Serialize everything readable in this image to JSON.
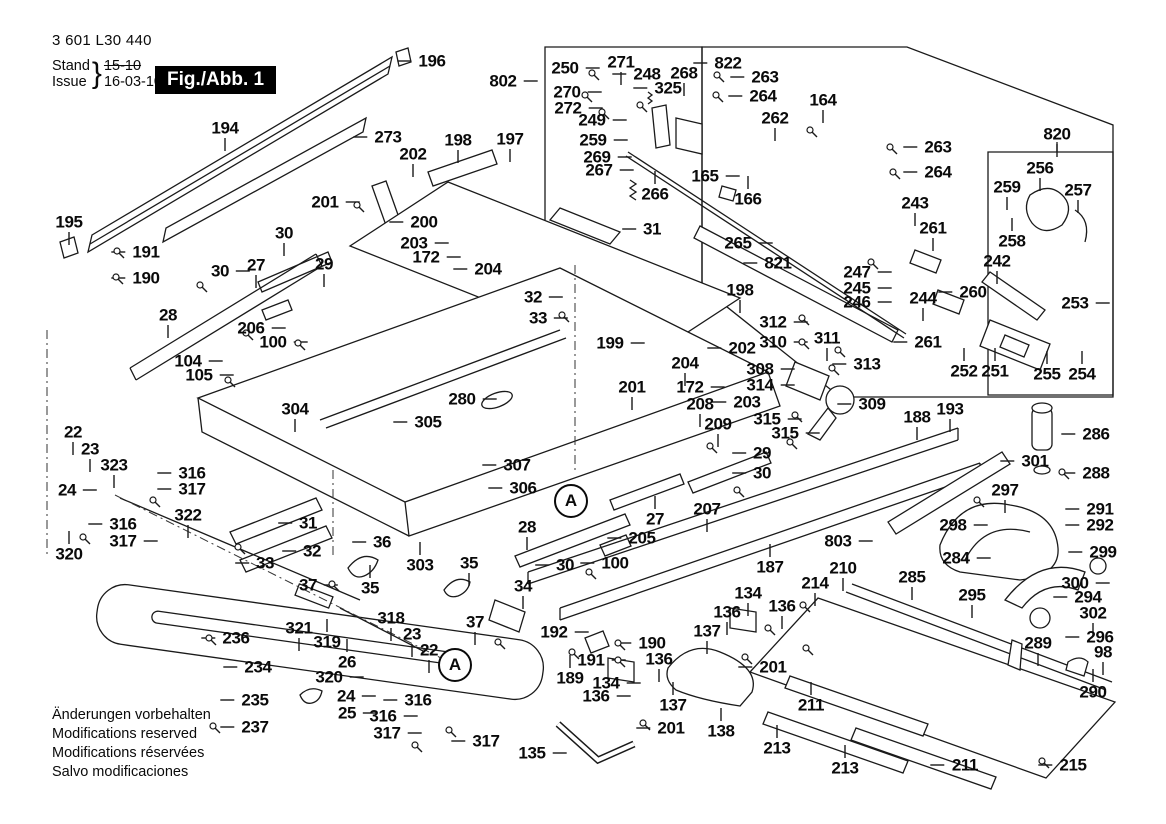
{
  "header": {
    "part_number": "3 601 L30 440",
    "stand_label": "Stand",
    "issue_label": "Issue",
    "brace": "}",
    "old_date": "15-10",
    "new_date": "16-03-10"
  },
  "figure_box": {
    "label": "Fig./Abb. 1"
  },
  "footer_lines": [
    "Änderungen vorbehalten",
    "Modifications reserved",
    "Modifications réservées",
    "Salvo modificaciones"
  ],
  "colors": {
    "ink": "#1a1a1a",
    "paper": "#ffffff"
  },
  "detail_markers": [
    {
      "label": "A",
      "x": 571,
      "y": 501
    },
    {
      "label": "A",
      "x": 455,
      "y": 665
    }
  ],
  "part_labels": [
    {
      "t": "194",
      "x": 225,
      "y": 128,
      "d": "b"
    },
    {
      "t": "195",
      "x": 69,
      "y": 222,
      "d": "b"
    },
    {
      "t": "196",
      "x": 432,
      "y": 61,
      "d": "l"
    },
    {
      "t": "273",
      "x": 388,
      "y": 137,
      "d": "l"
    },
    {
      "t": "198",
      "x": 458,
      "y": 140,
      "d": "b"
    },
    {
      "t": "197",
      "x": 510,
      "y": 139,
      "d": "b"
    },
    {
      "t": "202",
      "x": 413,
      "y": 154,
      "d": "b"
    },
    {
      "t": "201",
      "x": 325,
      "y": 202,
      "d": "r"
    },
    {
      "t": "200",
      "x": 424,
      "y": 222,
      "d": "l"
    },
    {
      "t": "30",
      "x": 284,
      "y": 233,
      "d": "b"
    },
    {
      "t": "203",
      "x": 414,
      "y": 243,
      "d": "r"
    },
    {
      "t": "172",
      "x": 426,
      "y": 257,
      "d": "r"
    },
    {
      "t": "204",
      "x": 488,
      "y": 269,
      "d": "l"
    },
    {
      "t": "27",
      "x": 256,
      "y": 265,
      "d": "b"
    },
    {
      "t": "29",
      "x": 324,
      "y": 264,
      "d": "b"
    },
    {
      "t": "30",
      "x": 220,
      "y": 271,
      "d": "r"
    },
    {
      "t": "191",
      "x": 146,
      "y": 252,
      "d": "l"
    },
    {
      "t": "190",
      "x": 146,
      "y": 278,
      "d": "l"
    },
    {
      "t": "28",
      "x": 168,
      "y": 315,
      "d": "b"
    },
    {
      "t": "206",
      "x": 251,
      "y": 328,
      "d": "r"
    },
    {
      "t": "100",
      "x": 273,
      "y": 342,
      "d": "r"
    },
    {
      "t": "104",
      "x": 188,
      "y": 361,
      "d": "r"
    },
    {
      "t": "105",
      "x": 199,
      "y": 375,
      "d": "r"
    },
    {
      "t": "802",
      "x": 503,
      "y": 81,
      "d": "r"
    },
    {
      "t": "250",
      "x": 565,
      "y": 68,
      "d": "r"
    },
    {
      "t": "271",
      "x": 621,
      "y": 62,
      "d": "b"
    },
    {
      "t": "248",
      "x": 647,
      "y": 74,
      "d": "l"
    },
    {
      "t": "268",
      "x": 684,
      "y": 73,
      "d": "b"
    },
    {
      "t": "325",
      "x": 668,
      "y": 88,
      "d": "l"
    },
    {
      "t": "270",
      "x": 567,
      "y": 92,
      "d": "r"
    },
    {
      "t": "272",
      "x": 568,
      "y": 108,
      "d": "r"
    },
    {
      "t": "249",
      "x": 592,
      "y": 120,
      "d": "r"
    },
    {
      "t": "259",
      "x": 593,
      "y": 140,
      "d": "r"
    },
    {
      "t": "269",
      "x": 597,
      "y": 157,
      "d": "r"
    },
    {
      "t": "267",
      "x": 599,
      "y": 170,
      "d": "r"
    },
    {
      "t": "266",
      "x": 655,
      "y": 194,
      "d": "t"
    },
    {
      "t": "265",
      "x": 738,
      "y": 243,
      "d": "r"
    },
    {
      "t": "821",
      "x": 778,
      "y": 263,
      "d": "l"
    },
    {
      "t": "31",
      "x": 652,
      "y": 229,
      "d": "l"
    },
    {
      "t": "165",
      "x": 705,
      "y": 176,
      "d": "r"
    },
    {
      "t": "166",
      "x": 748,
      "y": 199,
      "d": "t"
    },
    {
      "t": "822",
      "x": 728,
      "y": 63,
      "d": "l"
    },
    {
      "t": "263",
      "x": 765,
      "y": 77,
      "d": "l"
    },
    {
      "t": "264",
      "x": 763,
      "y": 96,
      "d": "l"
    },
    {
      "t": "164",
      "x": 823,
      "y": 100,
      "d": "b"
    },
    {
      "t": "262",
      "x": 775,
      "y": 118,
      "d": "b"
    },
    {
      "t": "263",
      "x": 938,
      "y": 147,
      "d": "l"
    },
    {
      "t": "264",
      "x": 938,
      "y": 172,
      "d": "l"
    },
    {
      "t": "243",
      "x": 915,
      "y": 203,
      "d": "b"
    },
    {
      "t": "261",
      "x": 933,
      "y": 228,
      "d": "b"
    },
    {
      "t": "820",
      "x": 1057,
      "y": 134,
      "d": "b"
    },
    {
      "t": "256",
      "x": 1040,
      "y": 168,
      "d": "b"
    },
    {
      "t": "259",
      "x": 1007,
      "y": 187,
      "d": "b"
    },
    {
      "t": "257",
      "x": 1078,
      "y": 190,
      "d": "b"
    },
    {
      "t": "258",
      "x": 1012,
      "y": 241,
      "d": "t"
    },
    {
      "t": "242",
      "x": 997,
      "y": 261,
      "d": "b"
    },
    {
      "t": "260",
      "x": 973,
      "y": 292,
      "d": "l"
    },
    {
      "t": "253",
      "x": 1075,
      "y": 303,
      "d": "r"
    },
    {
      "t": "252",
      "x": 964,
      "y": 371,
      "d": "t"
    },
    {
      "t": "251",
      "x": 995,
      "y": 371,
      "d": "t"
    },
    {
      "t": "255",
      "x": 1047,
      "y": 374,
      "d": "t"
    },
    {
      "t": "254",
      "x": 1082,
      "y": 374,
      "d": "t"
    },
    {
      "t": "247",
      "x": 857,
      "y": 272,
      "d": "r"
    },
    {
      "t": "245",
      "x": 857,
      "y": 288,
      "d": "r"
    },
    {
      "t": "246",
      "x": 857,
      "y": 302,
      "d": "r"
    },
    {
      "t": "244",
      "x": 923,
      "y": 298,
      "d": "b"
    },
    {
      "t": "261",
      "x": 928,
      "y": 342,
      "d": "l"
    },
    {
      "t": "32",
      "x": 533,
      "y": 297,
      "d": "r"
    },
    {
      "t": "33",
      "x": 538,
      "y": 318,
      "d": "r"
    },
    {
      "t": "199",
      "x": 610,
      "y": 343,
      "d": "r"
    },
    {
      "t": "201",
      "x": 632,
      "y": 387,
      "d": "b"
    },
    {
      "t": "198",
      "x": 740,
      "y": 290,
      "d": "b"
    },
    {
      "t": "202",
      "x": 742,
      "y": 348,
      "d": "l"
    },
    {
      "t": "204",
      "x": 685,
      "y": 363,
      "d": "b"
    },
    {
      "t": "172",
      "x": 690,
      "y": 387,
      "d": "r"
    },
    {
      "t": "203",
      "x": 747,
      "y": 402,
      "d": "l"
    },
    {
      "t": "208",
      "x": 700,
      "y": 404,
      "d": "b"
    },
    {
      "t": "209",
      "x": 718,
      "y": 424,
      "d": "b"
    },
    {
      "t": "312",
      "x": 773,
      "y": 322,
      "d": "r"
    },
    {
      "t": "310",
      "x": 773,
      "y": 342,
      "d": "r"
    },
    {
      "t": "311",
      "x": 827,
      "y": 338,
      "d": "b"
    },
    {
      "t": "313",
      "x": 867,
      "y": 364,
      "d": "l"
    },
    {
      "t": "308",
      "x": 760,
      "y": 369,
      "d": "r"
    },
    {
      "t": "314",
      "x": 760,
      "y": 385,
      "d": "r"
    },
    {
      "t": "315",
      "x": 767,
      "y": 419,
      "d": "r"
    },
    {
      "t": "315",
      "x": 785,
      "y": 433,
      "d": "r"
    },
    {
      "t": "309",
      "x": 872,
      "y": 404,
      "d": "l"
    },
    {
      "t": "188",
      "x": 917,
      "y": 417,
      "d": "b"
    },
    {
      "t": "193",
      "x": 950,
      "y": 409,
      "d": "b"
    },
    {
      "t": "280",
      "x": 462,
      "y": 399,
      "d": "r"
    },
    {
      "t": "305",
      "x": 428,
      "y": 422,
      "d": "l"
    },
    {
      "t": "307",
      "x": 517,
      "y": 465,
      "d": "l"
    },
    {
      "t": "306",
      "x": 523,
      "y": 488,
      "d": "l"
    },
    {
      "t": "304",
      "x": 295,
      "y": 409,
      "d": "b"
    },
    {
      "t": "29",
      "x": 762,
      "y": 453,
      "d": "l"
    },
    {
      "t": "30",
      "x": 762,
      "y": 473,
      "d": "l"
    },
    {
      "t": "27",
      "x": 655,
      "y": 519,
      "d": "t"
    },
    {
      "t": "205",
      "x": 642,
      "y": 538,
      "d": "l"
    },
    {
      "t": "100",
      "x": 615,
      "y": 563,
      "d": "l"
    },
    {
      "t": "30",
      "x": 565,
      "y": 565,
      "d": "l"
    },
    {
      "t": "28",
      "x": 527,
      "y": 527,
      "d": "b"
    },
    {
      "t": "207",
      "x": 707,
      "y": 509,
      "d": "b"
    },
    {
      "t": "187",
      "x": 770,
      "y": 567,
      "d": "t"
    },
    {
      "t": "803",
      "x": 838,
      "y": 541,
      "d": "r"
    },
    {
      "t": "210",
      "x": 843,
      "y": 568,
      "d": "b"
    },
    {
      "t": "214",
      "x": 815,
      "y": 583,
      "d": "b"
    },
    {
      "t": "22",
      "x": 73,
      "y": 432,
      "d": "b"
    },
    {
      "t": "23",
      "x": 90,
      "y": 449,
      "d": "b"
    },
    {
      "t": "323",
      "x": 114,
      "y": 465,
      "d": "b"
    },
    {
      "t": "24",
      "x": 67,
      "y": 490,
      "d": "r"
    },
    {
      "t": "316",
      "x": 192,
      "y": 473,
      "d": "l"
    },
    {
      "t": "317",
      "x": 192,
      "y": 489,
      "d": "l"
    },
    {
      "t": "316",
      "x": 123,
      "y": 524,
      "d": "l"
    },
    {
      "t": "317",
      "x": 123,
      "y": 541,
      "d": "r"
    },
    {
      "t": "320",
      "x": 69,
      "y": 554,
      "d": "t"
    },
    {
      "t": "322",
      "x": 188,
      "y": 515,
      "d": "b"
    },
    {
      "t": "31",
      "x": 308,
      "y": 523,
      "d": "l"
    },
    {
      "t": "32",
      "x": 312,
      "y": 551,
      "d": "l"
    },
    {
      "t": "33",
      "x": 265,
      "y": 563,
      "d": "l"
    },
    {
      "t": "36",
      "x": 382,
      "y": 542,
      "d": "l"
    },
    {
      "t": "35",
      "x": 370,
      "y": 588,
      "d": "t"
    },
    {
      "t": "37",
      "x": 308,
      "y": 585,
      "d": "r"
    },
    {
      "t": "303",
      "x": 420,
      "y": 565,
      "d": "t"
    },
    {
      "t": "35",
      "x": 469,
      "y": 563,
      "d": "b"
    },
    {
      "t": "34",
      "x": 523,
      "y": 586,
      "d": "b"
    },
    {
      "t": "37",
      "x": 475,
      "y": 622,
      "d": "b"
    },
    {
      "t": "236",
      "x": 236,
      "y": 638,
      "d": "l"
    },
    {
      "t": "234",
      "x": 258,
      "y": 667,
      "d": "l"
    },
    {
      "t": "235",
      "x": 255,
      "y": 700,
      "d": "l"
    },
    {
      "t": "237",
      "x": 255,
      "y": 727,
      "d": "l"
    },
    {
      "t": "321",
      "x": 299,
      "y": 628,
      "d": "b"
    },
    {
      "t": "319",
      "x": 327,
      "y": 642,
      "d": "t"
    },
    {
      "t": "26",
      "x": 347,
      "y": 662,
      "d": "t"
    },
    {
      "t": "320",
      "x": 329,
      "y": 677,
      "d": "r"
    },
    {
      "t": "24",
      "x": 346,
      "y": 696,
      "d": "r"
    },
    {
      "t": "25",
      "x": 347,
      "y": 713,
      "d": "r"
    },
    {
      "t": "318",
      "x": 391,
      "y": 618,
      "d": "b"
    },
    {
      "t": "23",
      "x": 412,
      "y": 634,
      "d": "b"
    },
    {
      "t": "22",
      "x": 429,
      "y": 650,
      "d": "b"
    },
    {
      "t": "316",
      "x": 418,
      "y": 700,
      "d": "l"
    },
    {
      "t": "316",
      "x": 383,
      "y": 716,
      "d": "r"
    },
    {
      "t": "317",
      "x": 387,
      "y": 733,
      "d": "r"
    },
    {
      "t": "317",
      "x": 486,
      "y": 741,
      "d": "l"
    },
    {
      "t": "192",
      "x": 554,
      "y": 632,
      "d": "r"
    },
    {
      "t": "190",
      "x": 652,
      "y": 643,
      "d": "l"
    },
    {
      "t": "191",
      "x": 591,
      "y": 660,
      "d": "r"
    },
    {
      "t": "189",
      "x": 570,
      "y": 678,
      "d": "t"
    },
    {
      "t": "134",
      "x": 748,
      "y": 593,
      "d": "b"
    },
    {
      "t": "136",
      "x": 727,
      "y": 612,
      "d": "b"
    },
    {
      "t": "136",
      "x": 782,
      "y": 606,
      "d": "b"
    },
    {
      "t": "137",
      "x": 707,
      "y": 631,
      "d": "b"
    },
    {
      "t": "201",
      "x": 773,
      "y": 667,
      "d": "l"
    },
    {
      "t": "136",
      "x": 659,
      "y": 659,
      "d": "b"
    },
    {
      "t": "134",
      "x": 606,
      "y": 683,
      "d": "r"
    },
    {
      "t": "136",
      "x": 596,
      "y": 696,
      "d": "r"
    },
    {
      "t": "137",
      "x": 673,
      "y": 705,
      "d": "t"
    },
    {
      "t": "201",
      "x": 671,
      "y": 728,
      "d": "l"
    },
    {
      "t": "135",
      "x": 532,
      "y": 753,
      "d": "r"
    },
    {
      "t": "138",
      "x": 721,
      "y": 731,
      "d": "t"
    },
    {
      "t": "213",
      "x": 777,
      "y": 748,
      "d": "t"
    },
    {
      "t": "211",
      "x": 811,
      "y": 705,
      "d": "t"
    },
    {
      "t": "213",
      "x": 845,
      "y": 768,
      "d": "t"
    },
    {
      "t": "211",
      "x": 965,
      "y": 765,
      "d": "l"
    },
    {
      "t": "215",
      "x": 1073,
      "y": 765,
      "d": "l"
    },
    {
      "t": "285",
      "x": 912,
      "y": 577,
      "d": "b"
    },
    {
      "t": "295",
      "x": 972,
      "y": 595,
      "d": "b"
    },
    {
      "t": "284",
      "x": 956,
      "y": 558,
      "d": "r"
    },
    {
      "t": "301",
      "x": 1035,
      "y": 461,
      "d": "l"
    },
    {
      "t": "286",
      "x": 1096,
      "y": 434,
      "d": "l"
    },
    {
      "t": "288",
      "x": 1096,
      "y": 473,
      "d": "l"
    },
    {
      "t": "297",
      "x": 1005,
      "y": 490,
      "d": "b"
    },
    {
      "t": "298",
      "x": 953,
      "y": 525,
      "d": "r"
    },
    {
      "t": "291",
      "x": 1100,
      "y": 509,
      "d": "l"
    },
    {
      "t": "292",
      "x": 1100,
      "y": 525,
      "d": "l"
    },
    {
      "t": "299",
      "x": 1103,
      "y": 552,
      "d": "l"
    },
    {
      "t": "300",
      "x": 1075,
      "y": 583,
      "d": "r"
    },
    {
      "t": "294",
      "x": 1088,
      "y": 597,
      "d": "l"
    },
    {
      "t": "302",
      "x": 1093,
      "y": 613,
      "d": "b"
    },
    {
      "t": "296",
      "x": 1100,
      "y": 637,
      "d": "l"
    },
    {
      "t": "289",
      "x": 1038,
      "y": 643,
      "d": "b"
    },
    {
      "t": "98",
      "x": 1103,
      "y": 652,
      "d": "b"
    },
    {
      "t": "290",
      "x": 1093,
      "y": 692,
      "d": "t"
    }
  ],
  "hardware_points": [
    {
      "x": 117,
      "y": 251
    },
    {
      "x": 116,
      "y": 277
    },
    {
      "x": 357,
      "y": 205
    },
    {
      "x": 200,
      "y": 285
    },
    {
      "x": 717,
      "y": 75
    },
    {
      "x": 716,
      "y": 95
    },
    {
      "x": 810,
      "y": 130
    },
    {
      "x": 890,
      "y": 147
    },
    {
      "x": 893,
      "y": 172
    },
    {
      "x": 298,
      "y": 343
    },
    {
      "x": 228,
      "y": 380
    },
    {
      "x": 209,
      "y": 638
    },
    {
      "x": 213,
      "y": 726
    },
    {
      "x": 802,
      "y": 318
    },
    {
      "x": 802,
      "y": 342
    },
    {
      "x": 832,
      "y": 368
    },
    {
      "x": 838,
      "y": 350
    },
    {
      "x": 795,
      "y": 415
    },
    {
      "x": 790,
      "y": 442
    },
    {
      "x": 710,
      "y": 446
    },
    {
      "x": 737,
      "y": 490
    },
    {
      "x": 803,
      "y": 605
    },
    {
      "x": 745,
      "y": 657
    },
    {
      "x": 643,
      "y": 723
    },
    {
      "x": 589,
      "y": 572
    },
    {
      "x": 562,
      "y": 315
    },
    {
      "x": 238,
      "y": 547
    },
    {
      "x": 332,
      "y": 584
    },
    {
      "x": 498,
      "y": 642
    },
    {
      "x": 977,
      "y": 500
    },
    {
      "x": 153,
      "y": 500
    },
    {
      "x": 83,
      "y": 537
    },
    {
      "x": 415,
      "y": 745
    },
    {
      "x": 449,
      "y": 730
    },
    {
      "x": 1062,
      "y": 472
    },
    {
      "x": 1042,
      "y": 761
    },
    {
      "x": 618,
      "y": 643
    },
    {
      "x": 618,
      "y": 660
    },
    {
      "x": 572,
      "y": 652
    },
    {
      "x": 871,
      "y": 262
    },
    {
      "x": 246,
      "y": 333
    },
    {
      "x": 768,
      "y": 628
    },
    {
      "x": 806,
      "y": 648
    },
    {
      "x": 592,
      "y": 73
    },
    {
      "x": 585,
      "y": 95
    },
    {
      "x": 602,
      "y": 112
    },
    {
      "x": 640,
      "y": 105
    }
  ]
}
